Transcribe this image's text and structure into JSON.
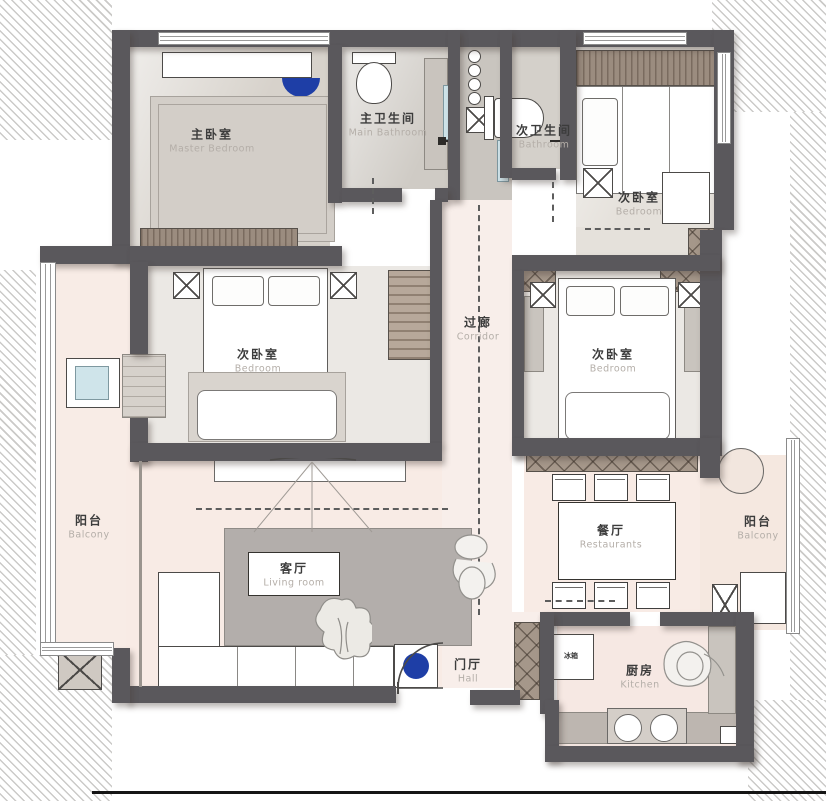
{
  "canvas": {
    "width": 826,
    "height": 801
  },
  "palette": {
    "wall": "#5a585c",
    "hatch_line": "#cbcac8",
    "floor_warm": "#dcd7d1",
    "floor_pink": "#f8ebe5",
    "wardrobe_brown": "#9b8c7f",
    "rug_gray": "#b3aeab",
    "accent_blue": "#1e3ea6",
    "window_blue": "#cfe4ea"
  },
  "rooms": {
    "master_bedroom": {
      "zh": "主卧室",
      "en": "Master Bedroom"
    },
    "main_bathroom": {
      "zh": "主卫生间",
      "en": "Main Bathroom"
    },
    "second_bathroom": {
      "zh": "次卫生间",
      "en": "Bathroom"
    },
    "bedroom_top_right": {
      "zh": "次卧室",
      "en": "Bedroom"
    },
    "corridor": {
      "zh": "过廊",
      "en": "Corridor"
    },
    "bedroom_left": {
      "zh": "次卧室",
      "en": "Bedroom"
    },
    "bedroom_right": {
      "zh": "次卧室",
      "en": "Bedroom"
    },
    "balcony_left": {
      "zh": "阳台",
      "en": "Balcony"
    },
    "dining_room": {
      "zh": "餐厅",
      "en": "Restaurants"
    },
    "balcony_right": {
      "zh": "阳台",
      "en": "Balcony"
    },
    "living_room": {
      "zh": "客厅",
      "en": "Living room"
    },
    "hall": {
      "zh": "门厅",
      "en": "Hall"
    },
    "kitchen": {
      "zh": "厨房",
      "en": "Kitchen"
    }
  },
  "appliances": {
    "fridge_label": "冰箱"
  }
}
